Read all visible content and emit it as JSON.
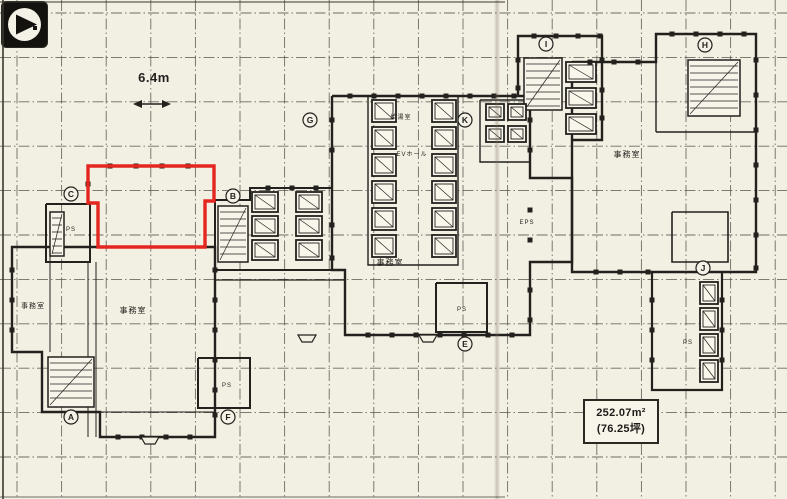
{
  "palette": {
    "paper": "#f2efe3",
    "ink": "#22211d",
    "red": "#e42620",
    "grid": "#57554c"
  },
  "dimension": {
    "label": "6.4m"
  },
  "area_box": {
    "line1": "252.07m²",
    "line2": "(76.25坪)"
  },
  "logo": {
    "name": "compass-logo"
  },
  "floorplan": {
    "grid": {
      "x0": 17,
      "dx": 44.6,
      "nx": 18,
      "y0": 13,
      "dy": 44.4,
      "ny": 12
    },
    "red_unit": {
      "points": "88,166 214,166 214,201 205,201 205,247 98,247 98,203 88,203"
    },
    "walls": [
      {
        "p": [
          [
            98,
            247
          ],
          [
            12,
            247
          ],
          [
            12,
            352
          ],
          [
            42,
            352
          ],
          [
            42,
            412
          ],
          [
            100,
            412
          ],
          [
            100,
            437
          ],
          [
            215,
            437
          ],
          [
            215,
            247
          ],
          [
            204,
            247
          ]
        ],
        "w": 2.4
      },
      {
        "p": [
          [
            88,
            262
          ],
          [
            88,
            437
          ]
        ],
        "w": 1
      },
      {
        "p": [
          [
            96,
            262
          ],
          [
            96,
            437
          ]
        ],
        "w": 1
      },
      {
        "p": [
          [
            50,
            247
          ],
          [
            50,
            352
          ]
        ],
        "w": 1
      },
      {
        "p": [
          [
            100,
            412
          ],
          [
            215,
            412
          ]
        ],
        "w": 1
      },
      {
        "p": [
          [
            215,
            200
          ],
          [
            250,
            200
          ],
          [
            250,
            188
          ],
          [
            332,
            188
          ],
          [
            332,
            270
          ],
          [
            215,
            270
          ],
          [
            215,
            200
          ]
        ],
        "w": 2
      },
      {
        "p": [
          [
            215,
            280
          ],
          [
            345,
            280
          ]
        ],
        "w": 1.2
      },
      {
        "p": [
          [
            332,
            96
          ],
          [
            530,
            96
          ],
          [
            530,
            178
          ],
          [
            572,
            178
          ],
          [
            572,
            262
          ],
          [
            530,
            262
          ],
          [
            530,
            335
          ],
          [
            345,
            335
          ],
          [
            345,
            270
          ],
          [
            332,
            270
          ],
          [
            332,
            96
          ]
        ],
        "w": 2.4
      },
      {
        "p": [
          [
            368,
            96
          ],
          [
            368,
            265
          ],
          [
            458,
            265
          ],
          [
            458,
            96
          ]
        ],
        "w": 1.4
      },
      {
        "p": [
          [
            480,
            100
          ],
          [
            530,
            100
          ],
          [
            530,
            162
          ],
          [
            480,
            162
          ],
          [
            480,
            100
          ]
        ],
        "w": 1.4
      },
      {
        "p": [
          [
            518,
            96
          ],
          [
            518,
            36
          ],
          [
            602,
            36
          ],
          [
            602,
            140
          ],
          [
            572,
            140
          ]
        ],
        "w": 2.4
      },
      {
        "p": [
          [
            572,
            62
          ],
          [
            656,
            62
          ],
          [
            656,
            34
          ],
          [
            756,
            34
          ],
          [
            756,
            272
          ],
          [
            572,
            272
          ],
          [
            572,
            62
          ]
        ],
        "w": 2.4
      },
      {
        "p": [
          [
            656,
            34
          ],
          [
            656,
            132
          ]
        ],
        "w": 1.4
      },
      {
        "p": [
          [
            656,
            132
          ],
          [
            756,
            132
          ]
        ],
        "w": 1.4
      },
      {
        "p": [
          [
            652,
            272
          ],
          [
            652,
            390
          ],
          [
            722,
            390
          ],
          [
            722,
            272
          ]
        ],
        "w": 2.2
      },
      {
        "p": [
          [
            46,
            204
          ],
          [
            90,
            204
          ],
          [
            90,
            262
          ],
          [
            46,
            262
          ],
          [
            46,
            204
          ]
        ],
        "w": 2
      },
      {
        "p": [
          [
            672,
            212
          ],
          [
            728,
            212
          ],
          [
            728,
            262
          ],
          [
            672,
            262
          ],
          [
            672,
            212
          ]
        ],
        "w": 1.6
      },
      {
        "p": [
          [
            436,
            283
          ],
          [
            487,
            283
          ],
          [
            487,
            332
          ],
          [
            436,
            332
          ],
          [
            436,
            283
          ]
        ],
        "w": 2
      },
      {
        "p": [
          [
            198,
            358
          ],
          [
            250,
            358
          ],
          [
            250,
            408
          ],
          [
            198,
            408
          ],
          [
            198,
            358
          ]
        ],
        "w": 2
      }
    ],
    "stairs": [
      {
        "x": 48,
        "y": 357,
        "w": 46,
        "h": 50
      },
      {
        "x": 218,
        "y": 206,
        "w": 30,
        "h": 56
      },
      {
        "x": 524,
        "y": 58,
        "w": 38,
        "h": 52
      },
      {
        "x": 688,
        "y": 60,
        "w": 52,
        "h": 56
      },
      {
        "x": 50,
        "y": 212,
        "w": 14,
        "h": 44
      }
    ],
    "cells": [
      [
        252,
        192,
        26,
        20
      ],
      [
        252,
        216,
        26,
        20
      ],
      [
        252,
        240,
        26,
        20
      ],
      [
        296,
        192,
        26,
        20
      ],
      [
        296,
        216,
        26,
        20
      ],
      [
        296,
        240,
        26,
        20
      ],
      [
        372,
        100,
        24,
        22
      ],
      [
        372,
        127,
        24,
        22
      ],
      [
        372,
        154,
        24,
        22
      ],
      [
        372,
        181,
        24,
        22
      ],
      [
        372,
        208,
        24,
        22
      ],
      [
        372,
        235,
        24,
        22
      ],
      [
        432,
        100,
        24,
        22
      ],
      [
        432,
        127,
        24,
        22
      ],
      [
        432,
        154,
        24,
        22
      ],
      [
        432,
        181,
        24,
        22
      ],
      [
        432,
        208,
        24,
        22
      ],
      [
        432,
        235,
        24,
        22
      ],
      [
        486,
        104,
        18,
        16
      ],
      [
        508,
        104,
        18,
        16
      ],
      [
        486,
        126,
        18,
        16
      ],
      [
        508,
        126,
        18,
        16
      ],
      [
        700,
        282,
        18,
        22
      ],
      [
        700,
        308,
        18,
        22
      ],
      [
        700,
        334,
        18,
        22
      ],
      [
        700,
        360,
        18,
        22
      ],
      [
        566,
        62,
        30,
        20
      ],
      [
        566,
        88,
        30,
        20
      ],
      [
        566,
        114,
        30,
        20
      ]
    ],
    "dots": [
      [
        110,
        166
      ],
      [
        136,
        166
      ],
      [
        162,
        166
      ],
      [
        188,
        166
      ],
      [
        88,
        184
      ],
      [
        350,
        96
      ],
      [
        374,
        96
      ],
      [
        398,
        96
      ],
      [
        422,
        96
      ],
      [
        446,
        96
      ],
      [
        470,
        96
      ],
      [
        494,
        96
      ],
      [
        514,
        96
      ],
      [
        332,
        120
      ],
      [
        332,
        150
      ],
      [
        332,
        225
      ],
      [
        332,
        258
      ],
      [
        368,
        335
      ],
      [
        392,
        335
      ],
      [
        416,
        335
      ],
      [
        440,
        335
      ],
      [
        464,
        335
      ],
      [
        488,
        335
      ],
      [
        512,
        335
      ],
      [
        530,
        120
      ],
      [
        530,
        150
      ],
      [
        530,
        210
      ],
      [
        530,
        240
      ],
      [
        530,
        290
      ],
      [
        530,
        320
      ],
      [
        534,
        36
      ],
      [
        556,
        36
      ],
      [
        578,
        36
      ],
      [
        600,
        36
      ],
      [
        518,
        60
      ],
      [
        518,
        88
      ],
      [
        602,
        60
      ],
      [
        602,
        90
      ],
      [
        602,
        118
      ],
      [
        590,
        62
      ],
      [
        614,
        62
      ],
      [
        638,
        62
      ],
      [
        672,
        34
      ],
      [
        696,
        34
      ],
      [
        720,
        34
      ],
      [
        744,
        34
      ],
      [
        756,
        60
      ],
      [
        756,
        95
      ],
      [
        756,
        130
      ],
      [
        756,
        165
      ],
      [
        756,
        200
      ],
      [
        756,
        235
      ],
      [
        756,
        268
      ],
      [
        596,
        272
      ],
      [
        620,
        272
      ],
      [
        648,
        272
      ],
      [
        722,
        300
      ],
      [
        722,
        330
      ],
      [
        722,
        360
      ],
      [
        652,
        300
      ],
      [
        652,
        330
      ],
      [
        652,
        360
      ],
      [
        12,
        270
      ],
      [
        12,
        300
      ],
      [
        12,
        330
      ],
      [
        118,
        437
      ],
      [
        142,
        437
      ],
      [
        166,
        437
      ],
      [
        190,
        437
      ],
      [
        215,
        270
      ],
      [
        215,
        300
      ],
      [
        215,
        330
      ],
      [
        215,
        360
      ],
      [
        215,
        390
      ],
      [
        215,
        415
      ],
      [
        268,
        188
      ],
      [
        292,
        188
      ],
      [
        316,
        188
      ]
    ],
    "tabs": [
      [
        150,
        437
      ],
      [
        307,
        335
      ],
      [
        428,
        335
      ]
    ],
    "dim_arrow": {
      "x1": 133,
      "x2": 171,
      "y": 104
    }
  },
  "labels": [
    {
      "text": "事務室",
      "x": 33,
      "y": 308,
      "size": 7
    },
    {
      "text": "事務室",
      "x": 133,
      "y": 313,
      "size": 8
    },
    {
      "text": "事務室",
      "x": 390,
      "y": 265,
      "size": 8
    },
    {
      "text": "事務室",
      "x": 627,
      "y": 157,
      "size": 8
    },
    {
      "text": "給湯室",
      "x": 401,
      "y": 119,
      "size": 6
    },
    {
      "text": "EVホール",
      "x": 412,
      "y": 156,
      "size": 6
    },
    {
      "text": "EPS",
      "x": 527,
      "y": 224,
      "size": 6
    },
    {
      "text": "PS",
      "x": 71,
      "y": 231,
      "size": 6
    },
    {
      "text": "PS",
      "x": 462,
      "y": 311,
      "size": 6
    },
    {
      "text": "PS",
      "x": 227,
      "y": 387,
      "size": 6
    },
    {
      "text": "PS",
      "x": 688,
      "y": 344,
      "size": 6
    }
  ],
  "bubbles": [
    {
      "label": "C",
      "x": 71,
      "y": 194
    },
    {
      "label": "B",
      "x": 233,
      "y": 196
    },
    {
      "label": "G",
      "x": 310,
      "y": 120
    },
    {
      "label": "K",
      "x": 465,
      "y": 120
    },
    {
      "label": "I",
      "x": 546,
      "y": 44
    },
    {
      "label": "H",
      "x": 705,
      "y": 45
    },
    {
      "label": "J",
      "x": 703,
      "y": 268
    },
    {
      "label": "A",
      "x": 71,
      "y": 417
    },
    {
      "label": "F",
      "x": 228,
      "y": 417
    },
    {
      "label": "E",
      "x": 465,
      "y": 344
    }
  ]
}
